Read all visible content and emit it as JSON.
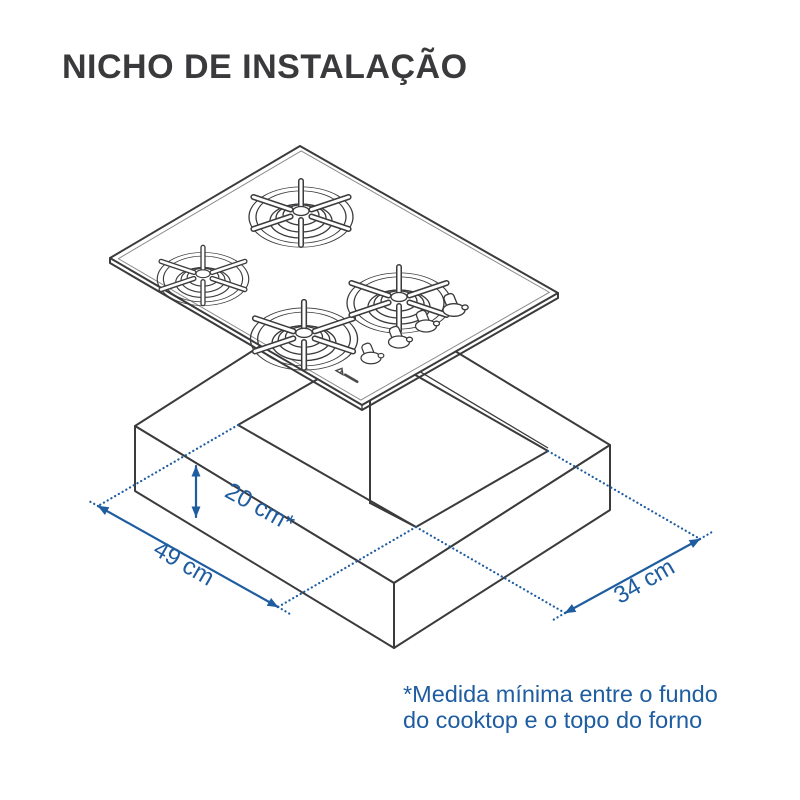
{
  "title": "NICHO DE INSTALAÇÃO",
  "dimensions": {
    "height_clearance": "20 cm*",
    "niche_width": "49 cm",
    "niche_depth": "34 cm"
  },
  "footnote": {
    "line1": "*Medida mínima entre o fundo",
    "line2": "do cooktop e o topo do forno"
  },
  "colors": {
    "dimension_blue": "#1f5da1",
    "line_dark": "#3b3b3d"
  },
  "illustration": {
    "cooktop": "4-burner-gas-cooktop-isometric",
    "niche": "countertop-niche-cutout"
  }
}
